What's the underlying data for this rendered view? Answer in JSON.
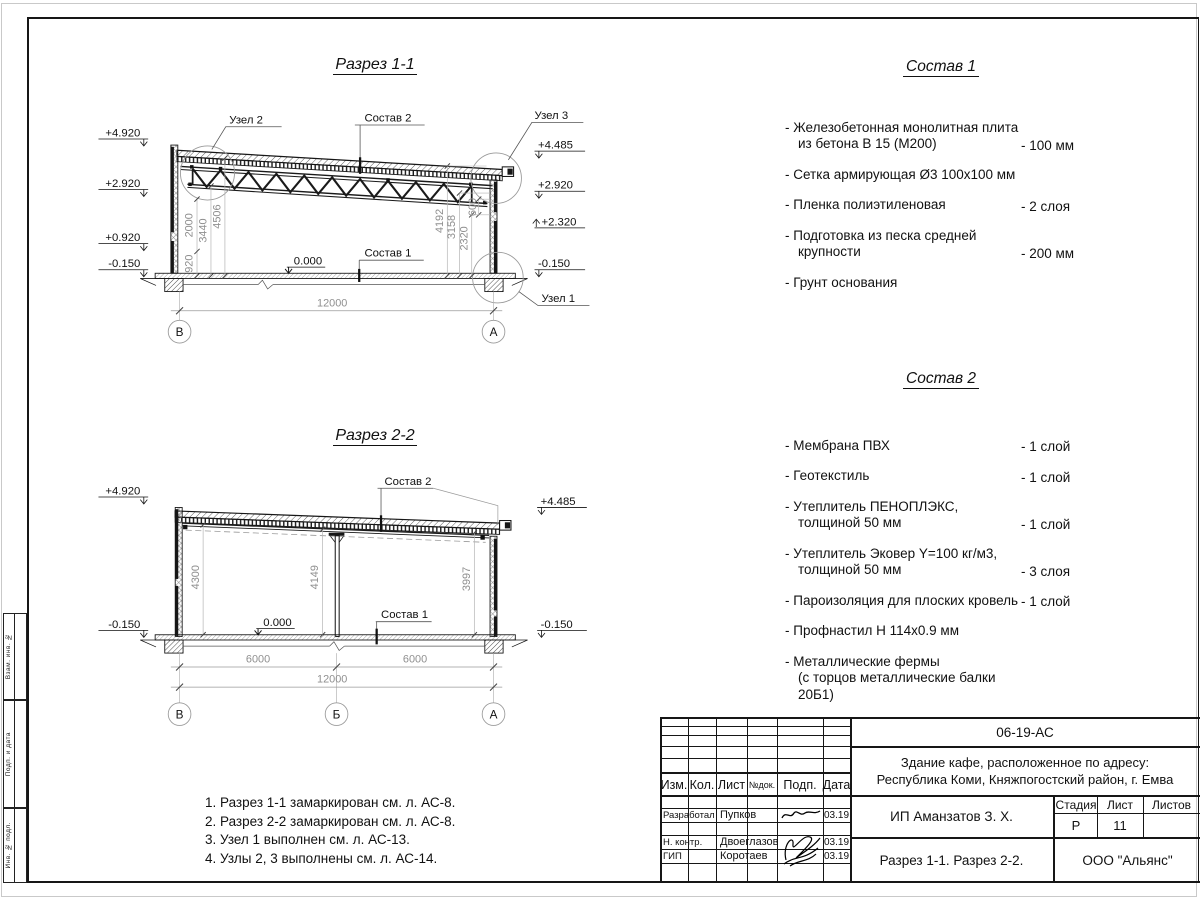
{
  "sheet": {
    "side_stamps": [
      "Взам. инв. №",
      "Подп. и дата",
      "Инв. № подл."
    ]
  },
  "section1": {
    "title": "Разрез 1-1",
    "levels_left": [
      "+4.920",
      "+2.920",
      "+0.920",
      "-0.150"
    ],
    "levels_right": [
      "+4.485",
      "+2.920",
      "+2.320",
      "-0.150"
    ],
    "dims_left": [
      "920",
      "2000",
      "3440",
      "4506"
    ],
    "dims_right": [
      "4192",
      "3158",
      "2320",
      "600"
    ],
    "dim_bottom": "12000",
    "zero": "0.000",
    "labels": {
      "uzel1": "Узел 1",
      "uzel2": "Узел 2",
      "uzel3": "Узел 3",
      "sostav1": "Состав 1",
      "sostav2": "Состав 2"
    },
    "axes": [
      "В",
      "А"
    ]
  },
  "section2": {
    "title": "Разрез 2-2",
    "levels_left": [
      "+4.920",
      "-0.150"
    ],
    "levels_right": [
      "+4.485",
      "-0.150"
    ],
    "dims_inner": [
      "4300",
      "4149",
      "3997"
    ],
    "dims_bottom": [
      "6000",
      "6000",
      "12000"
    ],
    "zero": "0.000",
    "labels": {
      "sostav1": "Состав 1",
      "sostav2": "Состав 2"
    },
    "axes": [
      "В",
      "Б",
      "А"
    ]
  },
  "sostav1": {
    "title": "Состав 1",
    "items": [
      {
        "name": "- Железобетонная  монолитная плита\nиз бетона В 15 (М200)",
        "value": "- 100 мм"
      },
      {
        "name": "- Сетка армирующая Ø3 100х100 мм",
        "value": ""
      },
      {
        "name": "- Пленка полиэтиленовая",
        "value": "-  2 слоя"
      },
      {
        "name": "- Подготовка из песка средней\nкрупности",
        "value": "- 200 мм"
      },
      {
        "name": "- Грунт основания",
        "value": ""
      }
    ]
  },
  "sostav2": {
    "title": "Состав 2",
    "items": [
      {
        "name": "- Мембрана ПВХ",
        "value": "- 1 слой"
      },
      {
        "name": "- Геотекстиль",
        "value": "- 1 слой"
      },
      {
        "name": "- Утеплитель ПЕНОПЛЭКС,\nтолщиной 50 мм",
        "value": "- 1 слой"
      },
      {
        "name": "- Утеплитель Эковер Y=100 кг/м3,\nтолщиной 50 мм",
        "value": "- 3 слоя"
      },
      {
        "name": "- Пароизоляция для плоских кровель",
        "value": "- 1 слой"
      },
      {
        "name": "- Профнастил Н 114х0.9 мм",
        "value": ""
      },
      {
        "name": "- Металлические фермы\n(с торцов металлические балки 20Б1)",
        "value": ""
      }
    ]
  },
  "notes": [
    "1. Разрез 1-1 замаркирован см. л. АС-8.",
    "2. Разрез 2-2 замаркирован см. л. АС-8.",
    "3. Узел 1 выполнен см. л. АС-13.",
    "4. Узлы 2, 3 выполнены см. л. АС-14."
  ],
  "titleblock": {
    "doc_code": "06-19-АС",
    "project_line1": "Здание кафе, расположенное по адресу:",
    "project_line2": "Республика Коми, Княжпогостский район, г. Емва",
    "client": "ИП Аманзатов З. Х.",
    "sheet_title": "Разрез 1-1. Разрез 2-2.",
    "company": "ООО \"Альянс\"",
    "stage_label": "Стадия",
    "sheet_label": "Лист",
    "sheets_label": "Листов",
    "stage": "Р",
    "sheet_no": "11",
    "cols": [
      "Изм.",
      "Кол.",
      "Лист",
      "№док.",
      "Подп.",
      "Дата"
    ],
    "rows": [
      {
        "role": "Разработал",
        "name": "Пупков",
        "date": "03.19"
      },
      {
        "role": "Н. контр.",
        "name": "Двоеглазов",
        "date": "03.19"
      },
      {
        "role": "ГИП",
        "name": "Коротаев",
        "date": "03.19"
      }
    ]
  }
}
